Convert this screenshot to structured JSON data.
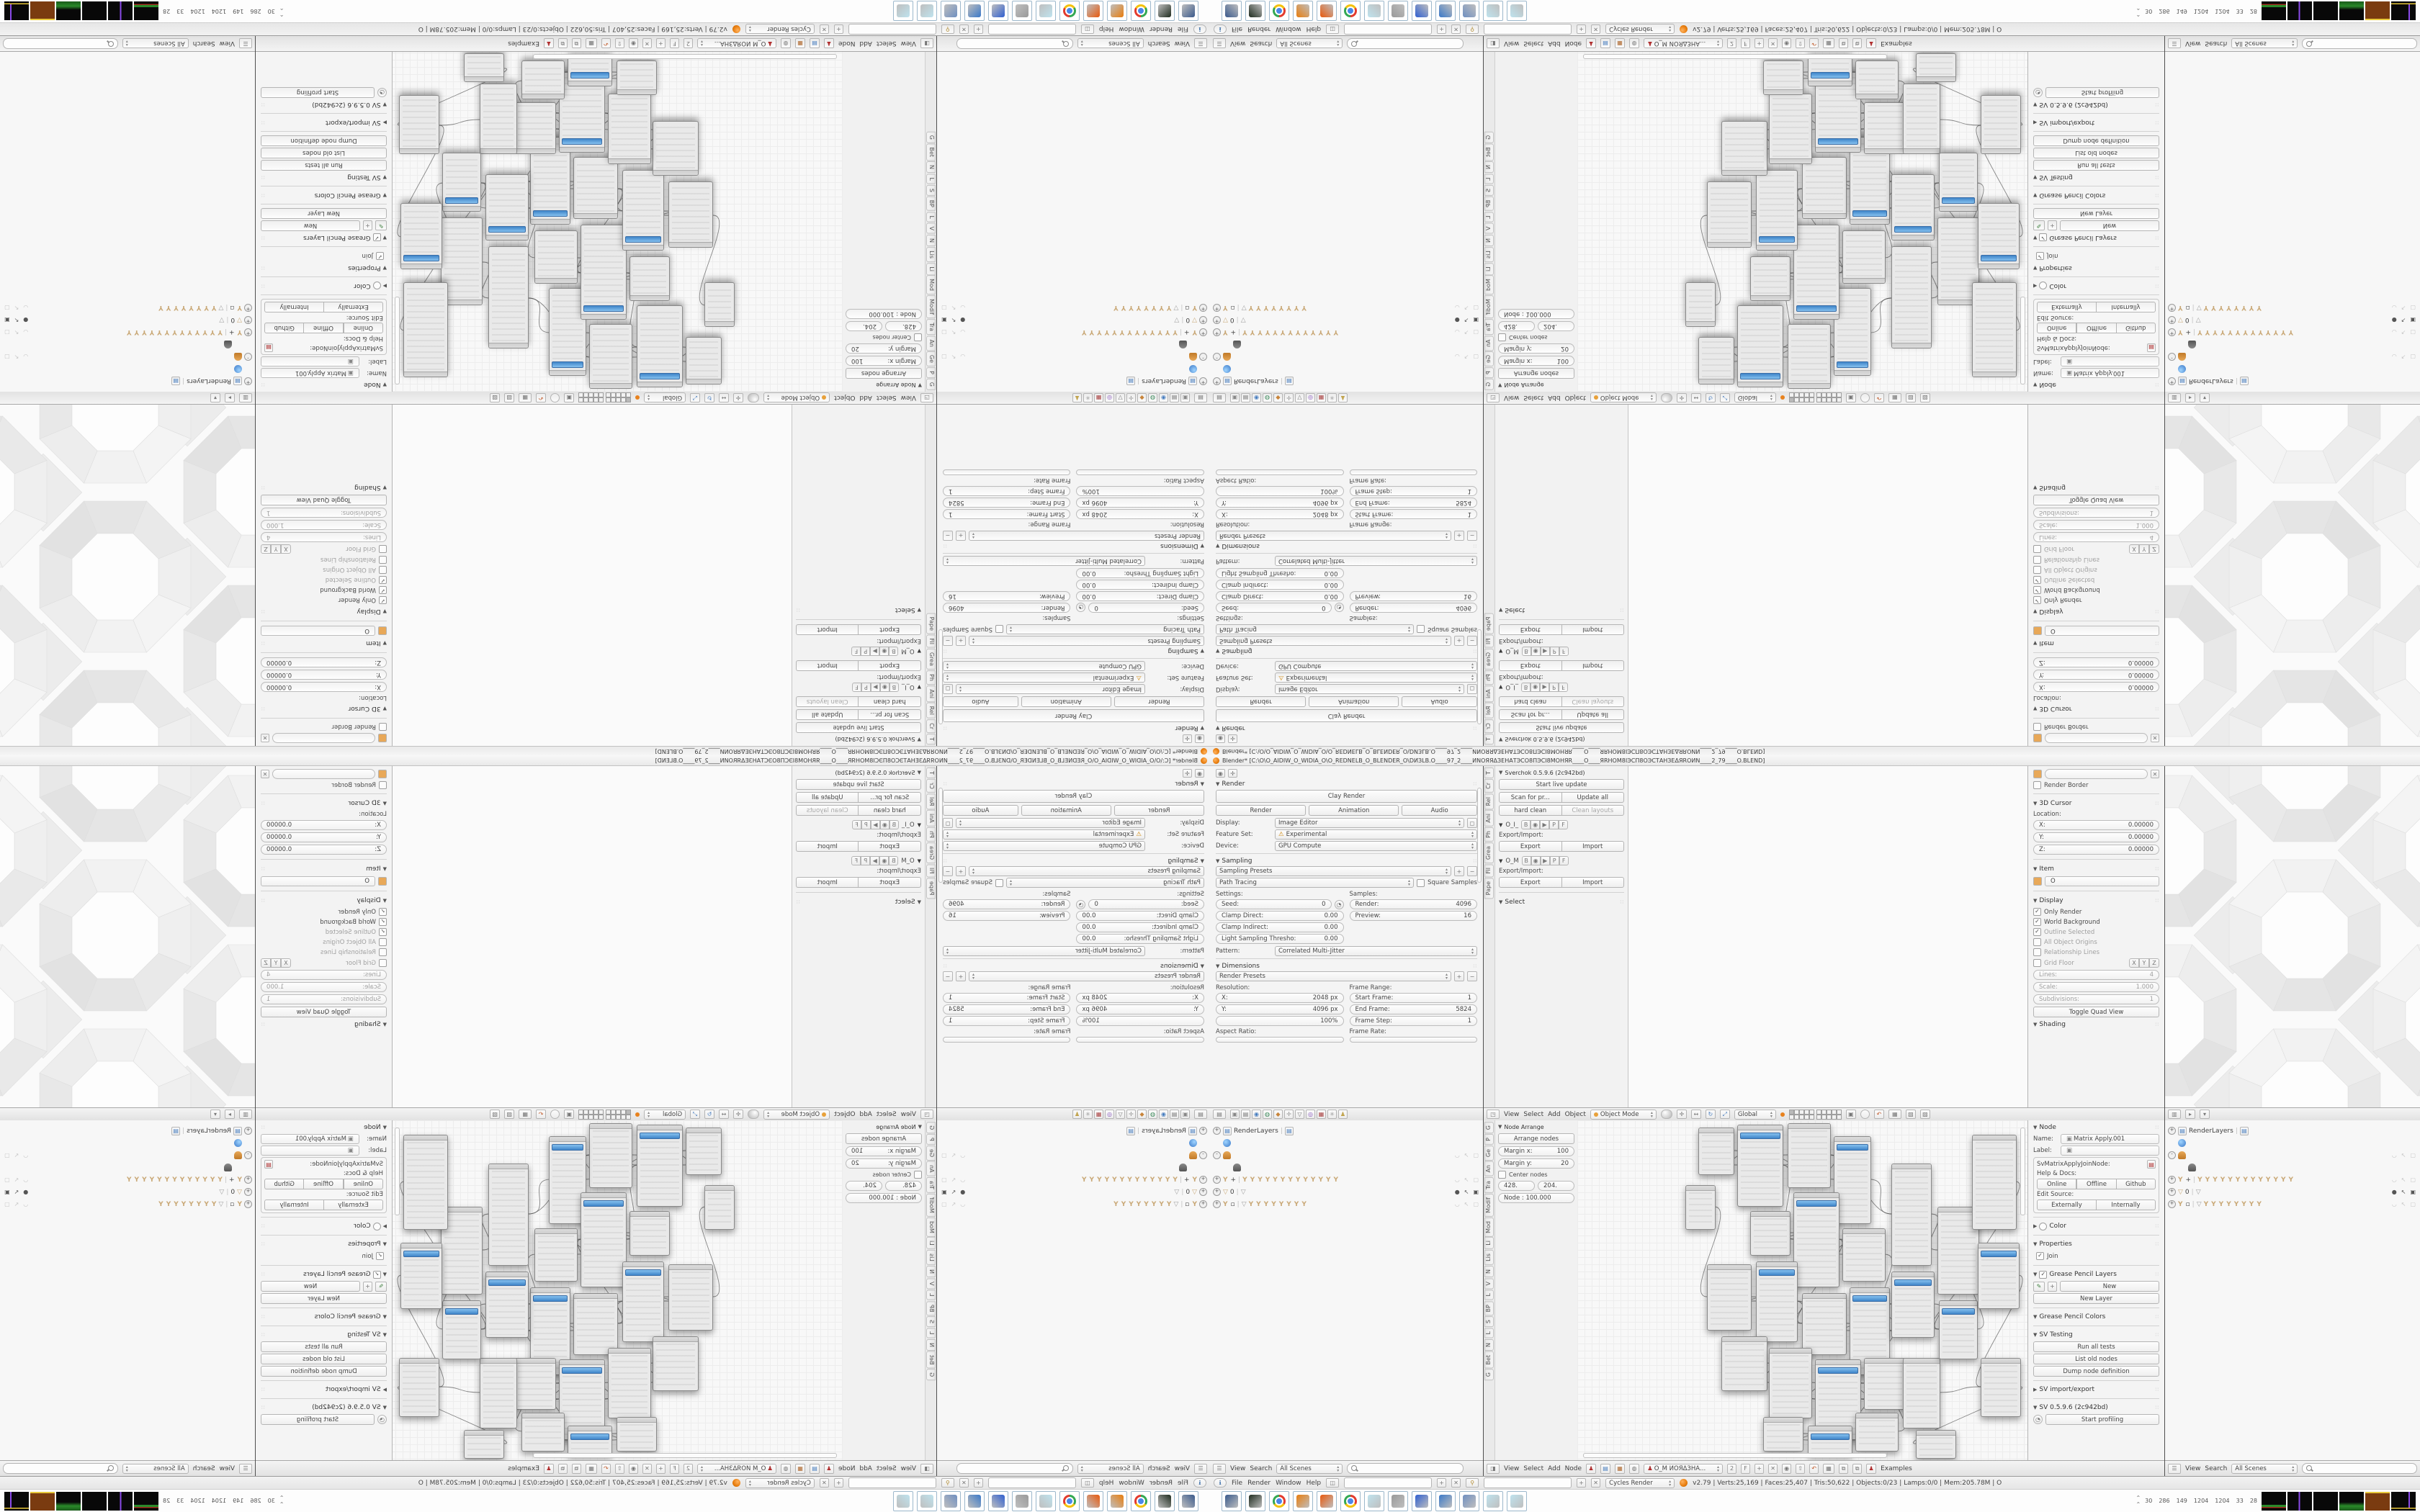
{
  "window": {
    "title": "Blender* [C:\\O\\O_AIDIW_O_WIDIA_O\\O_REDNELB_O_BLENDER_O\\DИЗLB.O____97_2____ИNОЯЯΔЗЕНАТЭСО8ПЭСI8МОНЯR____O____ЯRHOM8IЭСП8ОЭСТАНЗЕΔЯROИN____2_79____O.BLEND]"
  },
  "properties": {
    "render": {
      "title": "Render",
      "clay": "Clay Render",
      "render": "Render",
      "animation": "Animation",
      "audio": "Audio",
      "display_label": "Display:",
      "display": "Image Editor",
      "feature_label": "Feature Set:",
      "feature": "Experimental",
      "device_label": "Device:",
      "device": "GPU Compute"
    },
    "sampling": {
      "title": "Sampling",
      "presets": "Sampling Presets",
      "integrator": "Path Tracing",
      "square": "Square Samples",
      "settings": "Settings:",
      "samples": "Samples:",
      "seed": "Seed:",
      "seed_v": "0",
      "clamp_d": "Clamp Direct:",
      "clamp_d_v": "0.00",
      "clamp_i": "Clamp Indirect:",
      "clamp_i_v": "0.00",
      "light_t": "Light Sampling Thresho:",
      "light_t_v": "0.00",
      "render": "Render:",
      "render_v": "4096",
      "preview": "Preview:",
      "preview_v": "16",
      "pattern": "Pattern:",
      "pattern_v": "Correlated Multi-Jitter"
    },
    "dimensions": {
      "title": "Dimensions",
      "presets": "Render Presets",
      "resolution": "Resolution:",
      "x": "X:",
      "x_v": "2048 px",
      "y": "Y:",
      "y_v": "4096 px",
      "pct": "100%",
      "frame_range": "Frame Range:",
      "start": "Start Frame:",
      "start_v": "1",
      "end": "End Frame:",
      "end_v": "5824",
      "step": "Frame Step:",
      "step_v": "1",
      "aspect": "Aspect Ratio:",
      "rate": "Frame Rate:"
    }
  },
  "tool3d": {
    "tabs": [
      "T",
      "Cr",
      "Rel",
      "Ani",
      "Ph",
      "Grea",
      "Fil",
      "Pape"
    ],
    "sv_title": "Sverchok 0.5.9.6 (2c942bd)",
    "live": "Start live update",
    "scan": "Scan for pr...",
    "update": "Update all",
    "hard": "hard clean",
    "clean": "Clean layouts",
    "tree1": "O_I_",
    "tree2": "O_M",
    "toggles": [
      "B",
      "◉",
      "▶",
      "P",
      "F"
    ],
    "exp_imp": "Export/Import:",
    "export": "Export",
    "import": "Import",
    "select": "Select"
  },
  "view3d_header": {
    "menus": [
      "View",
      "Select",
      "Add",
      "Object"
    ],
    "mode": "Object Mode",
    "global": "Global"
  },
  "npanel3d": {
    "render_border": "Render Border",
    "cursor3d": "3D Cursor",
    "location": "Location:",
    "x": "X:",
    "y": "Y:",
    "z": "Z:",
    "zero": "0.00000",
    "item": "Item",
    "item_name": "O",
    "display": "Display",
    "only_render": "Only Render",
    "world_bg": "World Background",
    "outline": "Outline Selected",
    "origins": "All Object Origins",
    "rel_lines": "Relationship Lines",
    "grid_floor": "Grid Floor",
    "axes": [
      "X",
      "Y",
      "Z"
    ],
    "lines": "Lines:",
    "lines_v": "4",
    "scale": "Scale:",
    "scale_v": "1.000",
    "subdiv": "Subdivisions:",
    "subdiv_v": "1",
    "quad": "Toggle Quad View",
    "shading": "Shading"
  },
  "outliner": {
    "menus": [
      "View",
      "Search"
    ],
    "scenes": "All Scenes",
    "rows": [
      {
        "exp": "+",
        "icon": "layers",
        "label": "RenderLayers",
        "pipe": "layers",
        "glyphs": "",
        "ind": 0,
        "right": "none"
      },
      {
        "exp": "",
        "icon": "globe",
        "label": "",
        "glyphs": "",
        "ind": 1,
        "right": "none"
      },
      {
        "exp": "-",
        "icon": "person",
        "label": "",
        "glyphs": "",
        "ind": 0,
        "right": "soft"
      },
      {
        "exp": "",
        "icon": "person2",
        "label": "",
        "glyphs": "",
        "ind": 2,
        "right": "none"
      },
      {
        "exp": "+",
        "icon": "bone",
        "label": "+",
        "glyphs": "YYYYYYYYYYYYY",
        "ind": 0,
        "right": "soft"
      },
      {
        "exp": "+",
        "icon": "funnel",
        "label": "0",
        "glyphs": "▽",
        "ind": 0,
        "right": "eye"
      },
      {
        "exp": "+",
        "icon": "bone",
        "label": "▫",
        "glyphs": "▽YYYYYYYY",
        "ind": 0,
        "right": "soft"
      }
    ]
  },
  "node_tpanel": {
    "tabs": [
      "G",
      "P",
      "Ge",
      "An",
      "Tra",
      "Modif",
      "Mod",
      "Li",
      "Lis",
      "N",
      "V",
      "L",
      "BP",
      "S",
      "L",
      "N",
      "Bet",
      "G"
    ],
    "title": "Node Arrange",
    "arrange": "Arrange nodes",
    "mx": "Margin x:",
    "mx_v": "100",
    "my": "Margin y:",
    "my_v": "20",
    "center": "Center nodes",
    "f1": "428.",
    "f2": "204.",
    "node_f": "Node : 100.000"
  },
  "node_header": {
    "menus": [
      "View",
      "Select",
      "Add",
      "Node"
    ],
    "tree": "O_M ИОЯΔЗНА...",
    "users": "2",
    "fake": "F",
    "examples": "Examples"
  },
  "npanel_node": {
    "node": "Node",
    "name": "Name:",
    "name_v": "Matrix Apply.001",
    "label": "Label:",
    "label_v": "",
    "cls": "SvMatrixApplyJoinNode:",
    "help": "Help & Docs:",
    "online": "Online",
    "offline": "Offline",
    "github": "Github",
    "edit_src": "Edit Source:",
    "externally": "Externally",
    "internally": "Internally",
    "color": "Color",
    "properties": "Properties",
    "join": "Join",
    "gp_layers": "Grease Pencil Layers",
    "new": "New",
    "new_layer": "New Layer",
    "gp_colors": "Grease Pencil Colors",
    "sv_testing": "SV Testing",
    "run": "Run all tests",
    "list_old": "List old nodes",
    "dump": "Dump node definition",
    "sv_ie": "SV import/export",
    "sv_ver": "SV 0.5.9.6 (2c942bd)",
    "profiling": "Start profiling"
  },
  "infobar": {
    "menus": [
      "File",
      "Render",
      "Window",
      "Help"
    ],
    "engine": "Cycles Render",
    "stats": "v2.79 | Verts:25,169 | Faces:25,407 | Tris:50,622 | Objects:0/23 | Lamps:0/0 | Mem:205.78M | O"
  },
  "taskbar": {
    "icons": [
      "#3a5a8c",
      "#1e2b1e",
      "chrome",
      "#e87d0d",
      "#e8590d",
      "chrome",
      "#bfe3ee",
      "#9a9a9a",
      "#2f5fd0",
      "#3a78c8",
      "#6f8fc0",
      "#bfe3ee",
      "#bfe3ee"
    ],
    "tray_nums": [
      "30",
      "286",
      "149",
      "1204",
      "1204",
      "33",
      "28"
    ]
  },
  "chart_data": null,
  "graph": {
    "nodes": [
      [
        168,
        10,
        48,
        64,
        0
      ],
      [
        222,
        6,
        62,
        112,
        1
      ],
      [
        292,
        4,
        58,
        88,
        0
      ],
      [
        356,
        22,
        50,
        120,
        1
      ],
      [
        240,
        126,
        54,
        60,
        0
      ],
      [
        300,
        100,
        62,
        130,
        1
      ],
      [
        368,
        150,
        58,
        72,
        0
      ],
      [
        180,
        200,
        60,
        90,
        0
      ],
      [
        248,
        196,
        56,
        110,
        1
      ],
      [
        312,
        240,
        60,
        84,
        0
      ],
      [
        378,
        232,
        54,
        120,
        1
      ],
      [
        436,
        60,
        54,
        140,
        0
      ],
      [
        436,
        210,
        58,
        90,
        1
      ],
      [
        200,
        300,
        62,
        74,
        0
      ],
      [
        266,
        316,
        58,
        96,
        0
      ],
      [
        330,
        332,
        62,
        110,
        1
      ],
      [
        398,
        330,
        56,
        70,
        0
      ],
      [
        258,
        412,
        54,
        46,
        0
      ],
      [
        320,
        424,
        60,
        40,
        1
      ],
      [
        386,
        406,
        58,
        52,
        0
      ],
      [
        452,
        330,
        50,
        96,
        0
      ],
      [
        500,
        120,
        56,
        120,
        0
      ],
      [
        502,
        250,
        52,
        80,
        1
      ],
      [
        548,
        20,
        60,
        130,
        0
      ],
      [
        556,
        170,
        56,
        90,
        1
      ],
      [
        560,
        330,
        54,
        80,
        0
      ],
      [
        150,
        90,
        40,
        60,
        0
      ],
      [
        470,
        430,
        54,
        38,
        0
      ]
    ],
    "wires": [
      [
        0,
        1
      ],
      [
        1,
        2
      ],
      [
        2,
        3
      ],
      [
        1,
        5
      ],
      [
        4,
        5
      ],
      [
        5,
        6
      ],
      [
        3,
        11
      ],
      [
        11,
        21
      ],
      [
        7,
        8
      ],
      [
        8,
        9
      ],
      [
        9,
        10
      ],
      [
        10,
        12
      ],
      [
        6,
        12
      ],
      [
        12,
        22
      ],
      [
        13,
        14
      ],
      [
        14,
        15
      ],
      [
        15,
        16
      ],
      [
        16,
        20
      ],
      [
        17,
        18
      ],
      [
        18,
        19
      ],
      [
        19,
        20
      ],
      [
        20,
        25
      ],
      [
        21,
        22
      ],
      [
        22,
        24
      ],
      [
        23,
        24
      ],
      [
        24,
        25
      ],
      [
        8,
        15
      ],
      [
        5,
        9
      ],
      [
        26,
        7
      ],
      [
        2,
        11
      ],
      [
        15,
        19
      ],
      [
        10,
        16
      ],
      [
        25,
        27
      ]
    ]
  },
  "pattern_colors": {
    "bg": "#fafafa",
    "facets": [
      "#f2f2f2",
      "#ededed",
      "#e8e8e8",
      "#e2e2e2",
      "#e5e5e5",
      "#e9e9e9",
      "#efefef",
      "#f4f4f4"
    ],
    "inner": "#fdfdfd",
    "stroke": "#dedede",
    "connector": "#ececec"
  }
}
